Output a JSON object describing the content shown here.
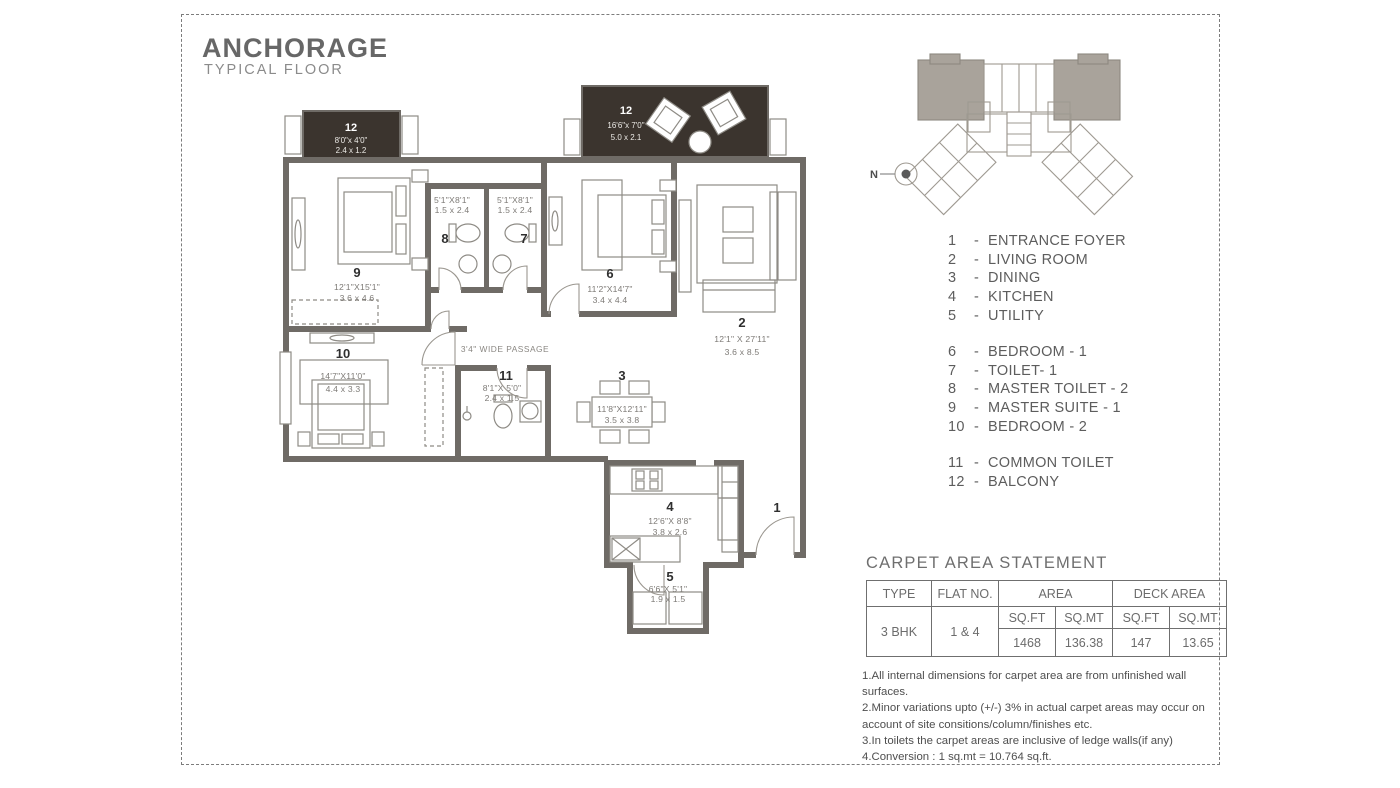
{
  "title": "ANCHORAGE",
  "subtitle": "TYPICAL FLOOR",
  "compass": {
    "label": "N"
  },
  "legend": {
    "separator": "-",
    "groups": [
      {
        "items": [
          {
            "num": "1",
            "label": "ENTRANCE FOYER"
          },
          {
            "num": "2",
            "label": "LIVING ROOM"
          },
          {
            "num": "3",
            "label": "DINING"
          },
          {
            "num": "4",
            "label": "KITCHEN"
          },
          {
            "num": "5",
            "label": "UTILITY"
          }
        ]
      },
      {
        "items": [
          {
            "num": "6",
            "label": "BEDROOM - 1"
          },
          {
            "num": "7",
            "label": "TOILET- 1"
          },
          {
            "num": "8",
            "label": "MASTER TOILET - 2"
          },
          {
            "num": "9",
            "label": "MASTER SUITE - 1"
          },
          {
            "num": "10",
            "label": "BEDROOM - 2"
          }
        ]
      },
      {
        "items": [
          {
            "num": "11",
            "label": "COMMON TOILET"
          },
          {
            "num": "12",
            "label": "BALCONY"
          }
        ]
      }
    ]
  },
  "plan": {
    "passage_label": "3'4\" WIDE PASSAGE",
    "rooms": {
      "r1": {
        "num": "1"
      },
      "r2": {
        "num": "2",
        "ft": "12'1\" X 27'11\"",
        "m": "3.6 x 8.5"
      },
      "r3": {
        "num": "3",
        "ft": "11'8\"X12'11\"",
        "m": "3.5 x 3.8"
      },
      "r4": {
        "num": "4",
        "ft": "12'6\"X 8'8\"",
        "m": "3.8 x 2.6"
      },
      "r5": {
        "num": "5",
        "ft": "6'6\"X 5'1\"",
        "m": "1.9 x 1.5"
      },
      "r6": {
        "num": "6",
        "ft": "11'2\"X14'7\"",
        "m": "3.4 x 4.4"
      },
      "r7": {
        "num": "7",
        "ft": "5'1\"X8'1\"",
        "m": "1.5 x 2.4"
      },
      "r8": {
        "num": "8",
        "ft": "5'1\"X8'1\"",
        "m": "1.5 x 2.4"
      },
      "r9": {
        "num": "9",
        "ft": "12'1\"X15'1\"",
        "m": "3.6 x 4.6"
      },
      "r10": {
        "num": "10",
        "ft": "14'7\"X11'0\"",
        "m": "4.4 x 3.3"
      },
      "r11": {
        "num": "11",
        "ft": "8'1\"X 5'0\"",
        "m": "2.4 x 1.5"
      },
      "b12a": {
        "num": "12",
        "ft": "8'0\"x 4'0\"",
        "m": "2.4 x 1.2"
      },
      "b12b": {
        "num": "12",
        "ft": "16'6\"x 7'0\"",
        "m": "5.0 x 2.1"
      }
    }
  },
  "carpet": {
    "heading": "CARPET AREA STATEMENT",
    "cols": {
      "type": "TYPE",
      "flat": "FLAT NO.",
      "area": "AREA",
      "deck": "DECK AREA",
      "sqft": "SQ.FT",
      "sqmt": "SQ.MT"
    },
    "row": {
      "type": "3 BHK",
      "flat": "1 & 4",
      "area_sqft": "1468",
      "area_sqmt": "136.38",
      "deck_sqft": "147",
      "deck_sqmt": "13.65"
    }
  },
  "notes": [
    "1.All internal dimensions for carpet area are from unfinished wall surfaces.",
    "2.Minor variations upto (+/-) 3% in actual carpet areas may occur on account of site consitions/column/finishes etc.",
    "3.In toilets the carpet areas are inclusive of ledge walls(if any)",
    "4.Conversion : 1 sq.mt = 10.764 sq.ft."
  ],
  "colors": {
    "wall": "#6F6B66",
    "balcony": "#3B342E",
    "text": "#5D5D5D"
  }
}
